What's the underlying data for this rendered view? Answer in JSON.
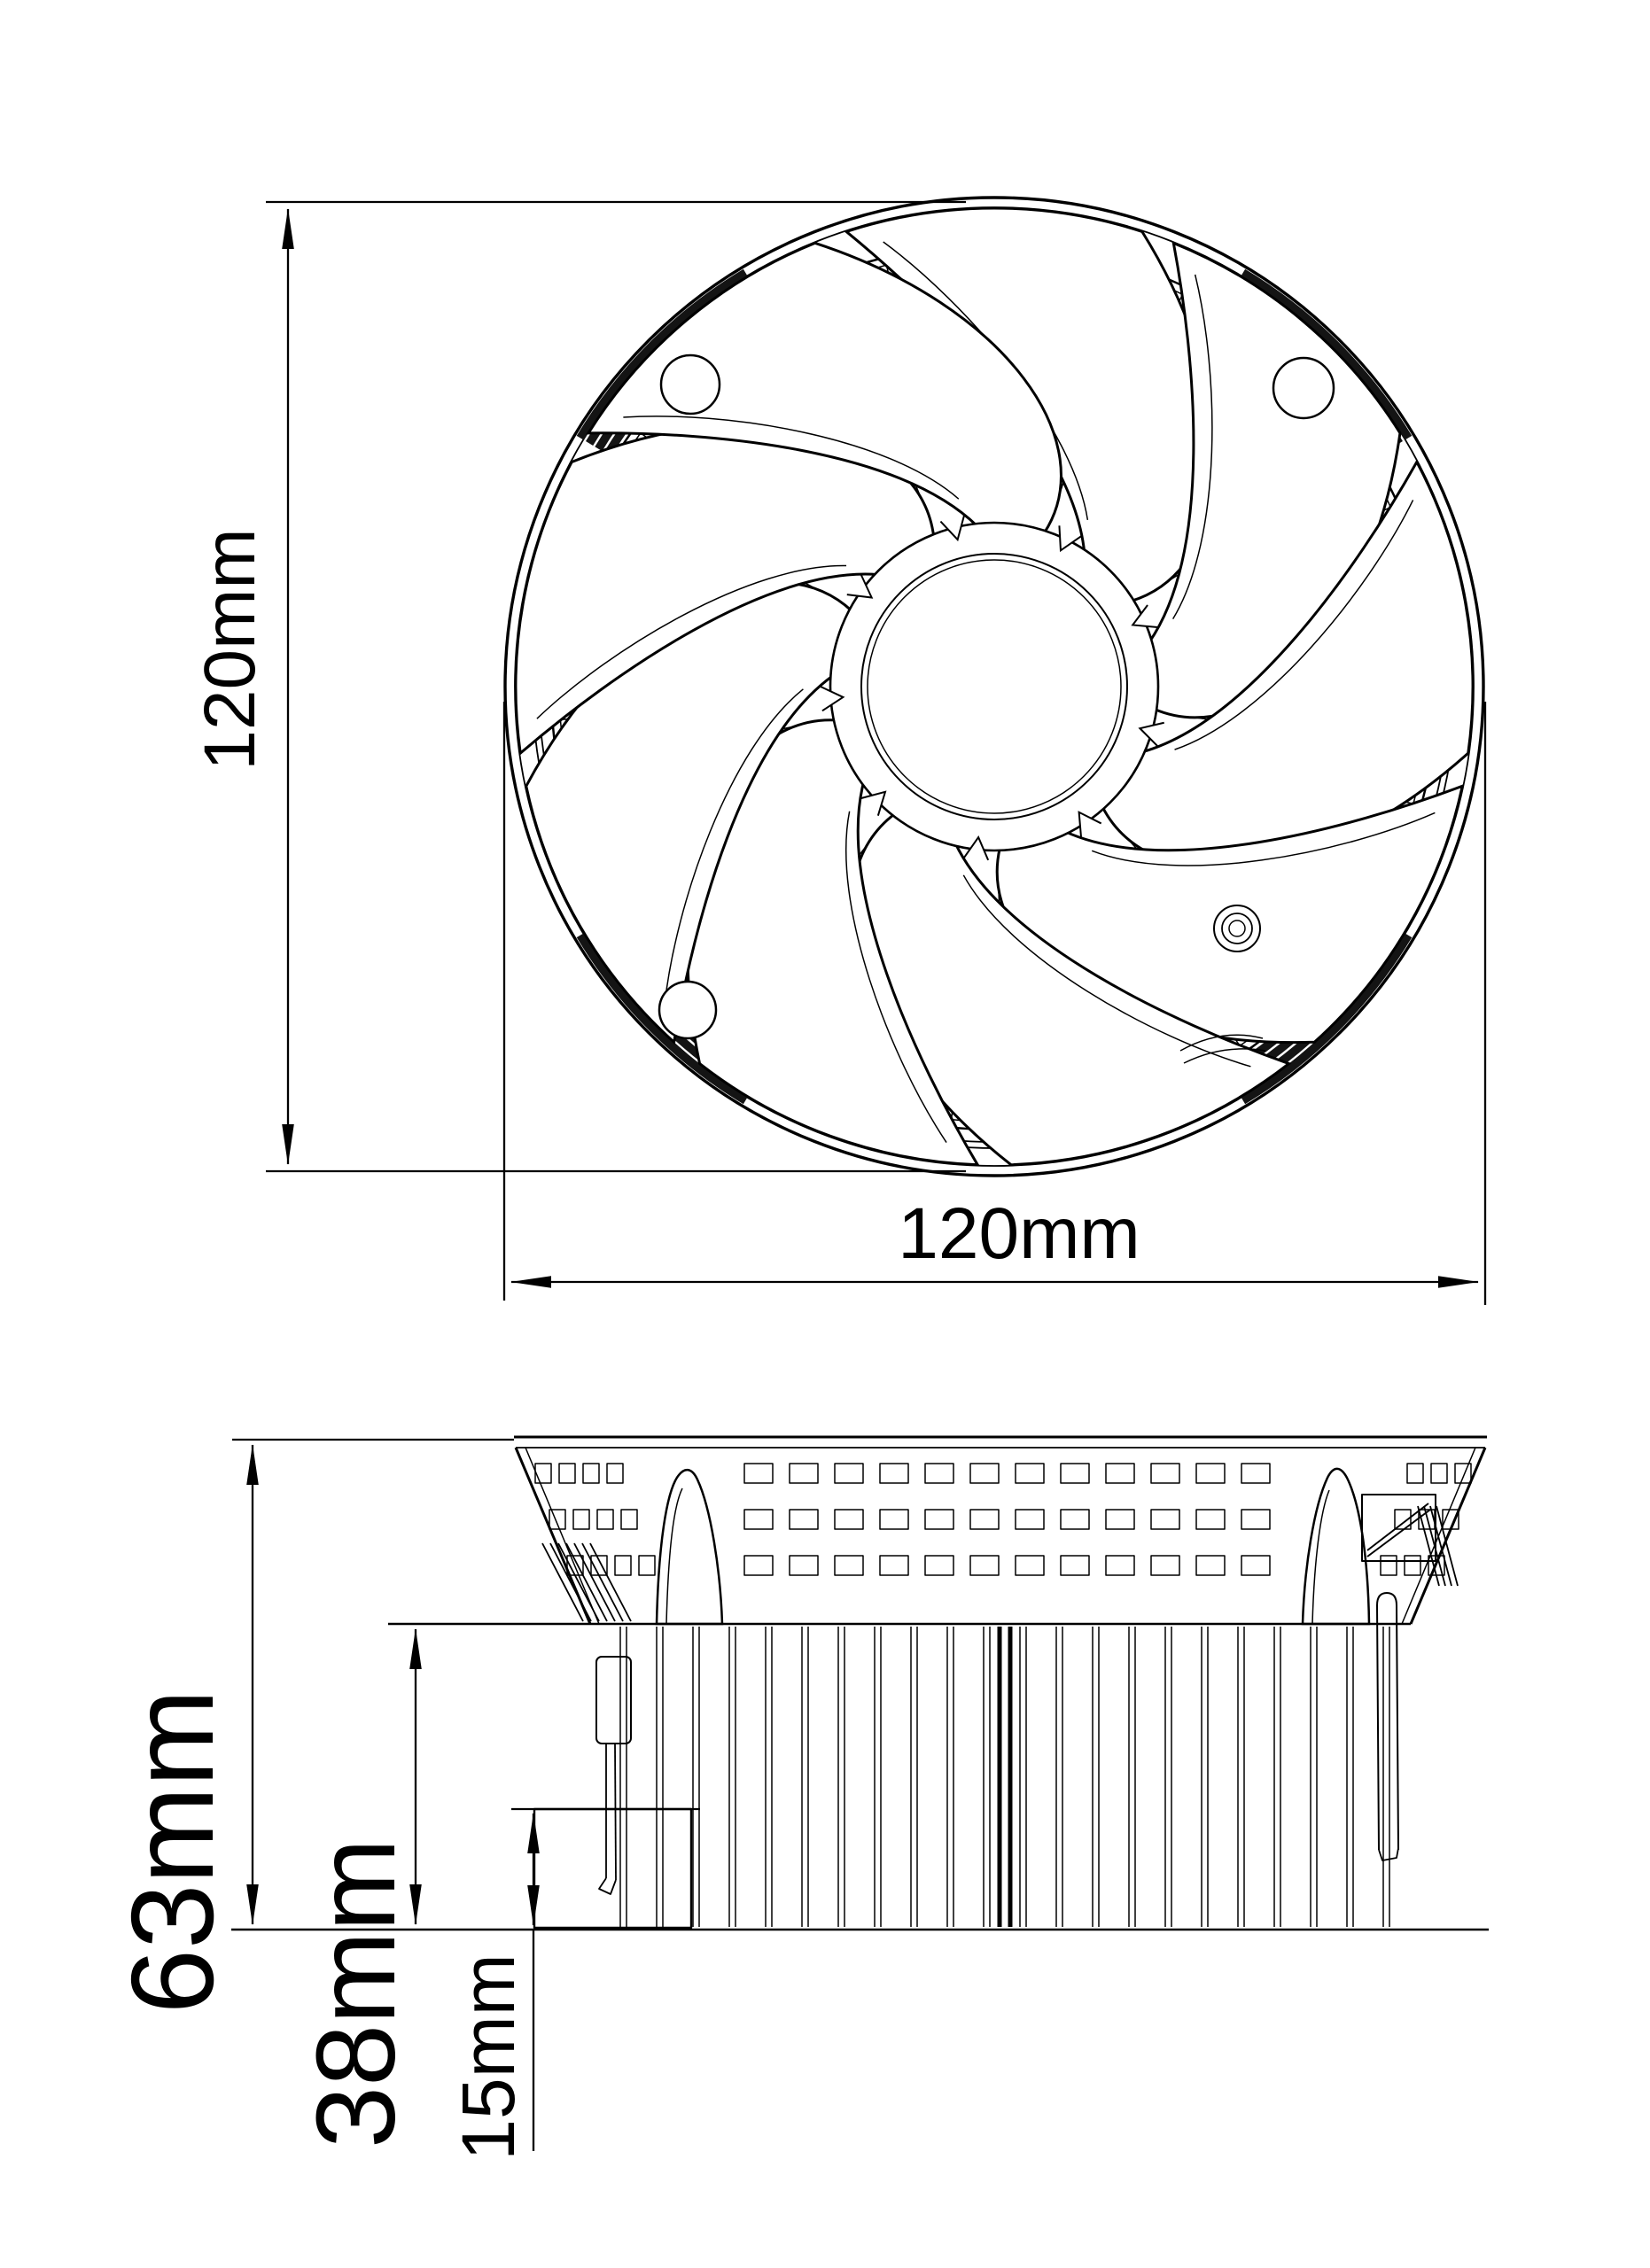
{
  "drawing": {
    "background": "#ffffff",
    "ink": "#000000",
    "top_view": {
      "height_label": "120mm",
      "width_label": "120mm"
    },
    "side_view": {
      "total_height_label": "63mm",
      "heatsink_height_label": "38mm",
      "base_height_label": "15mm"
    }
  }
}
